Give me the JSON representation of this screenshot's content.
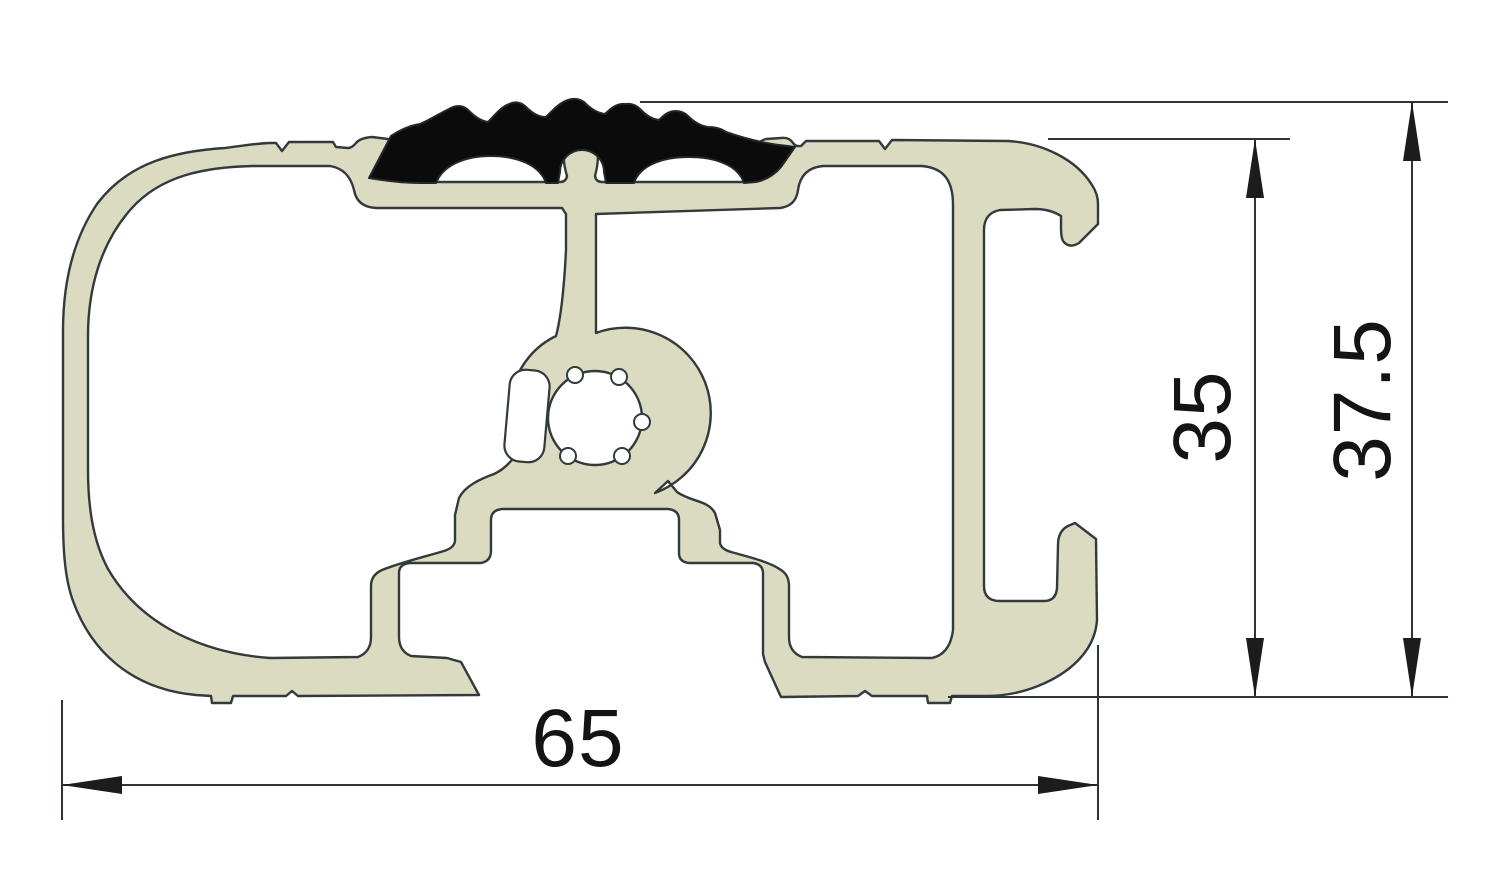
{
  "drawing": {
    "kind": "extrusion-profile-cross-section",
    "dimensions": {
      "width": {
        "label": "65"
      },
      "inner_height": {
        "label": "35"
      },
      "overall_height": {
        "label": "37.5"
      }
    },
    "colors": {
      "aluminum_fill": "#dadbc0",
      "rubber_fill": "#0b0b0b",
      "outline": "#333a3c",
      "dimension_line": "#2e3538",
      "arrow_fill": "#1c1c1c",
      "text": "#141414",
      "background": "#ffffff"
    }
  }
}
